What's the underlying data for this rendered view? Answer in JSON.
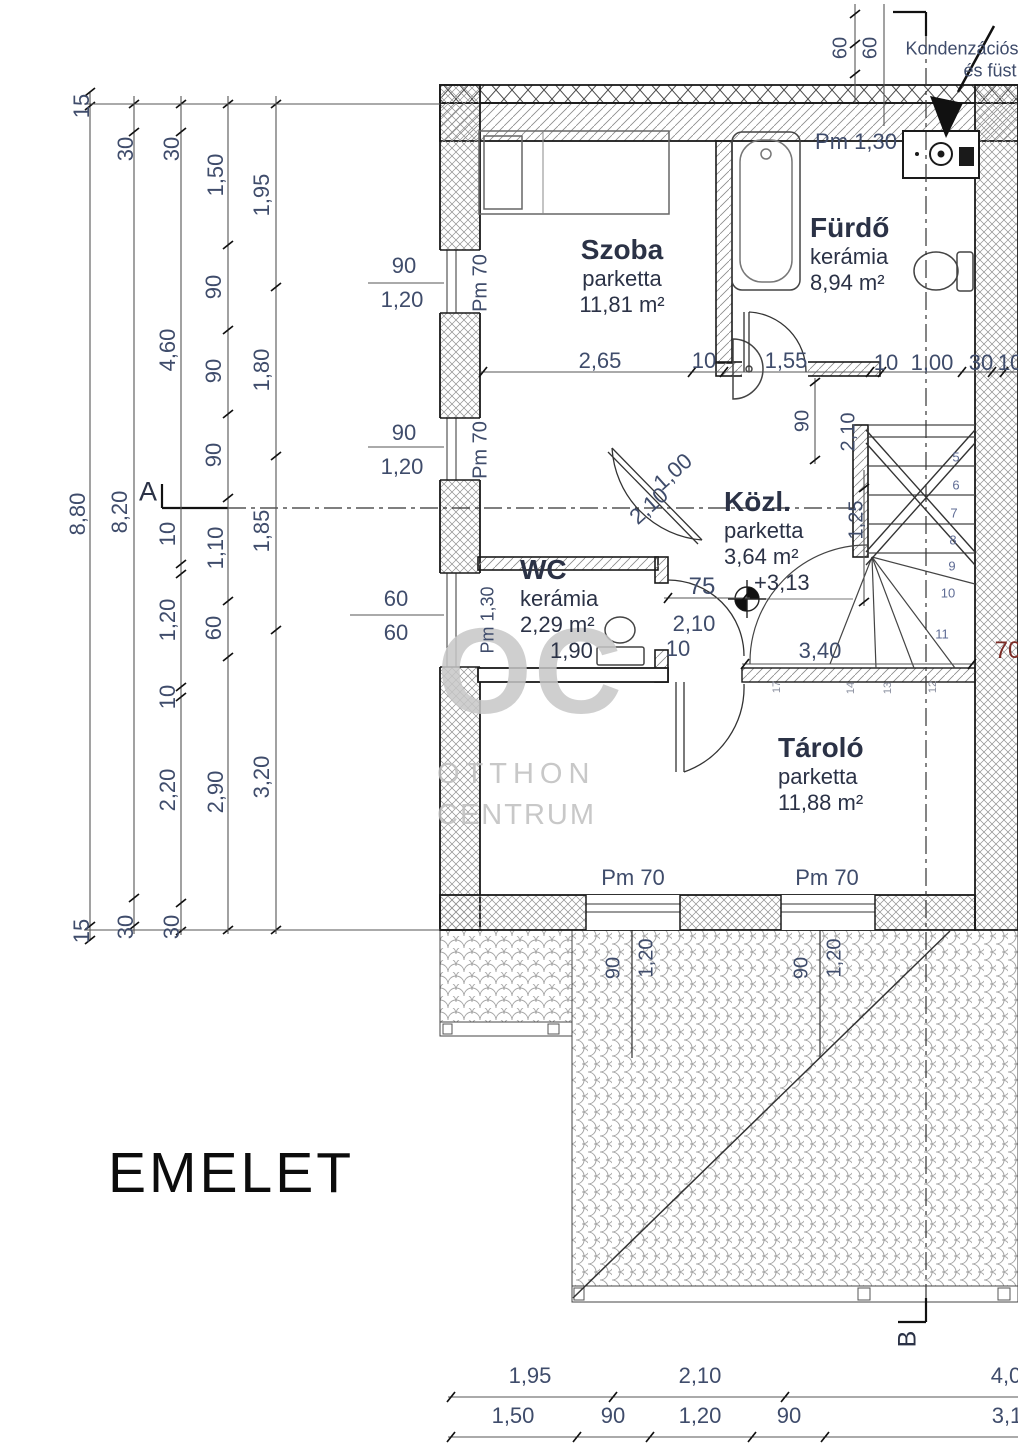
{
  "title": {
    "floor_label": "EMELET"
  },
  "watermark": {
    "line1": "OC",
    "line2": "OTTHON",
    "line3": "CENTRUM"
  },
  "annotation": {
    "line1": "Kondenzációs",
    "line2": "és füst"
  },
  "rooms": [
    {
      "name": "Szoba",
      "floor": "parketta",
      "area": "11,81 m²",
      "x": 622,
      "y": 234,
      "align": "center"
    },
    {
      "name": "Fürdő",
      "floor": "kerámia",
      "area": "8,94 m²",
      "x": 810,
      "y": 212,
      "align": "left"
    },
    {
      "name": "Közl.",
      "floor": "parketta",
      "area": "3,64 m²",
      "x": 724,
      "y": 486,
      "align": "left",
      "extra": "+3,13"
    },
    {
      "name": "WC",
      "floor": "kerámia",
      "area": "2,29 m²",
      "x": 520,
      "y": 554,
      "align": "left",
      "extra": "1,90"
    },
    {
      "name": "Tároló",
      "floor": "parketta",
      "area": "11,88 m²",
      "x": 778,
      "y": 732,
      "align": "left"
    }
  ],
  "labels": [
    {
      "n": "dim-left-a-15-top",
      "t": "15",
      "x": 82,
      "y": 106,
      "r": -90
    },
    {
      "n": "dim-left-a-880",
      "t": "8,80",
      "x": 78,
      "y": 514,
      "r": -90
    },
    {
      "n": "dim-left-a-15-bot",
      "t": "15",
      "x": 82,
      "y": 931,
      "r": -90
    },
    {
      "n": "dim-left-b-30-top",
      "t": "30",
      "x": 126,
      "y": 149,
      "r": -90
    },
    {
      "n": "dim-left-b-820",
      "t": "8,20",
      "x": 120,
      "y": 512,
      "r": -90
    },
    {
      "n": "dim-left-b-30-bot",
      "t": "30",
      "x": 126,
      "y": 927,
      "r": -90
    },
    {
      "n": "dim-left-c-30-top",
      "t": "30",
      "x": 172,
      "y": 149,
      "r": -90
    },
    {
      "n": "dim-left-c-460",
      "t": "4,60",
      "x": 168,
      "y": 350,
      "r": -90
    },
    {
      "n": "dim-left-c-10a",
      "t": "10",
      "x": 168,
      "y": 534,
      "r": -90
    },
    {
      "n": "dim-left-c-120",
      "t": "1,20",
      "x": 168,
      "y": 620,
      "r": -90
    },
    {
      "n": "dim-left-c-10b",
      "t": "10",
      "x": 168,
      "y": 697,
      "r": -90
    },
    {
      "n": "dim-left-c-220",
      "t": "2,20",
      "x": 168,
      "y": 790,
      "r": -90
    },
    {
      "n": "dim-left-c-30-bot",
      "t": "30",
      "x": 172,
      "y": 927,
      "r": -90
    },
    {
      "n": "dim-left-d-150",
      "t": "1,50",
      "x": 216,
      "y": 175,
      "r": -90
    },
    {
      "n": "dim-left-d-90a",
      "t": "90",
      "x": 214,
      "y": 287,
      "r": -90
    },
    {
      "n": "dim-left-d-90b",
      "t": "90",
      "x": 214,
      "y": 371,
      "r": -90
    },
    {
      "n": "dim-left-d-90c",
      "t": "90",
      "x": 214,
      "y": 455,
      "r": -90
    },
    {
      "n": "dim-left-d-110",
      "t": "1,10",
      "x": 216,
      "y": 548,
      "r": -90
    },
    {
      "n": "dim-left-d-60",
      "t": "60",
      "x": 214,
      "y": 628,
      "r": -90
    },
    {
      "n": "dim-left-d-290",
      "t": "2,90",
      "x": 216,
      "y": 792,
      "r": -90
    },
    {
      "n": "dim-left-e-195",
      "t": "1,95",
      "x": 262,
      "y": 195,
      "r": -90
    },
    {
      "n": "dim-left-e-180",
      "t": "1,80",
      "x": 262,
      "y": 370,
      "r": -90
    },
    {
      "n": "dim-left-e-185",
      "t": "1,85",
      "x": 262,
      "y": 531,
      "r": -90
    },
    {
      "n": "dim-left-e-320",
      "t": "3,20",
      "x": 262,
      "y": 777,
      "r": -90
    },
    {
      "n": "section-a-label",
      "t": "A",
      "x": 148,
      "y": 492,
      "s": 27,
      "c": "#2b3246"
    },
    {
      "n": "section-b-label",
      "t": "B",
      "x": 908,
      "y": 1339,
      "r": -90,
      "s": 25,
      "c": "#2b3246"
    },
    {
      "n": "dim-win1-90",
      "t": "90",
      "x": 404,
      "y": 266
    },
    {
      "n": "dim-win1-120",
      "t": "1,20",
      "x": 402,
      "y": 300
    },
    {
      "n": "dim-win2-90",
      "t": "90",
      "x": 404,
      "y": 433
    },
    {
      "n": "dim-win2-120",
      "t": "1,20",
      "x": 402,
      "y": 467
    },
    {
      "n": "dim-wcwin-60a",
      "t": "60",
      "x": 396,
      "y": 599
    },
    {
      "n": "dim-wcwin-60b",
      "t": "60",
      "x": 396,
      "y": 633
    },
    {
      "n": "win1-parapet",
      "t": "Pm 70",
      "x": 481,
      "y": 283,
      "r": -90,
      "s": 20
    },
    {
      "n": "win2-parapet",
      "t": "Pm 70",
      "x": 481,
      "y": 450,
      "r": -90,
      "s": 20
    },
    {
      "n": "wcwin-parapet",
      "t": "Pm 1,30",
      "x": 488,
      "y": 620,
      "r": -90,
      "s": 18
    },
    {
      "n": "dim-top-60a",
      "t": "60",
      "x": 841,
      "y": 48,
      "r": -90,
      "s": 20
    },
    {
      "n": "dim-top-60b",
      "t": "60",
      "x": 871,
      "y": 48,
      "r": -90,
      "s": 20
    },
    {
      "n": "furdo-parapet",
      "t": "Pm 1,30",
      "x": 856,
      "y": 142,
      "s": 22
    },
    {
      "n": "flue-note-line1",
      "t": "Kondenzációs",
      "x": 962,
      "y": 49,
      "s": 18
    },
    {
      "n": "flue-note-line2",
      "t": "és füst",
      "x": 990,
      "y": 71,
      "s": 18
    },
    {
      "n": "dim-mid-265",
      "t": "2,65",
      "x": 600,
      "y": 361
    },
    {
      "n": "dim-mid-10a",
      "t": "10",
      "x": 704,
      "y": 361
    },
    {
      "n": "dim-mid-155",
      "t": "1,55",
      "x": 786,
      "y": 361
    },
    {
      "n": "dim-mid-10b",
      "t": "10",
      "x": 886,
      "y": 363
    },
    {
      "n": "dim-mid-100",
      "t": "1,00",
      "x": 932,
      "y": 363
    },
    {
      "n": "dim-mid-30",
      "t": "30",
      "x": 981,
      "y": 363
    },
    {
      "n": "dim-mid-10c",
      "t": "10",
      "x": 1010,
      "y": 363
    },
    {
      "n": "dim-furdo-door-90",
      "t": "90",
      "x": 803,
      "y": 421,
      "r": -90,
      "s": 20
    },
    {
      "n": "dim-furdo-door-210",
      "t": "2,10",
      "x": 849,
      "y": 432,
      "r": -90,
      "s": 20
    },
    {
      "n": "dim-stair-125",
      "t": "1,25",
      "x": 857,
      "y": 520,
      "r": -90,
      "s": 20
    },
    {
      "n": "dim-szoba-door-100",
      "t": "1,00",
      "x": 673,
      "y": 472,
      "r": -42
    },
    {
      "n": "dim-szoba-door-210",
      "t": "2,10",
      "x": 649,
      "y": 506,
      "r": -42
    },
    {
      "n": "dim-wc-door-75",
      "t": "75",
      "x": 702,
      "y": 587,
      "s": 24
    },
    {
      "n": "dim-wc-door-210",
      "t": "2,10",
      "x": 694,
      "y": 624
    },
    {
      "n": "dim-wc-door-10",
      "t": "10",
      "x": 678,
      "y": 649
    },
    {
      "n": "stair-step-5",
      "t": "5",
      "x": 956,
      "y": 457,
      "s": 13,
      "c": "#5f6c95"
    },
    {
      "n": "stair-step-6",
      "t": "6",
      "x": 956,
      "y": 485,
      "s": 13,
      "c": "#5f6c95"
    },
    {
      "n": "stair-step-7",
      "t": "7",
      "x": 954,
      "y": 513,
      "s": 13,
      "c": "#5f6c95"
    },
    {
      "n": "stair-step-8",
      "t": "8",
      "x": 953,
      "y": 540,
      "s": 13,
      "c": "#5f6c95"
    },
    {
      "n": "stair-step-9",
      "t": "9",
      "x": 952,
      "y": 566,
      "s": 13,
      "c": "#5f6c95"
    },
    {
      "n": "stair-step-10",
      "t": "10",
      "x": 948,
      "y": 593,
      "s": 13,
      "c": "#5f6c95"
    },
    {
      "n": "stair-step-11",
      "t": "11",
      "x": 942,
      "y": 634,
      "s": 13,
      "c": "#5f6c95"
    },
    {
      "n": "stair-step-17",
      "t": "17",
      "x": 777,
      "y": 687,
      "r": -90,
      "s": 11,
      "c": "#8a8f9f"
    },
    {
      "n": "stair-step-14",
      "t": "14",
      "x": 851,
      "y": 688,
      "r": -90,
      "s": 11,
      "c": "#8a8f9f"
    },
    {
      "n": "stair-step-13",
      "t": "13",
      "x": 888,
      "y": 688,
      "r": -90,
      "s": 11,
      "c": "#8a8f9f"
    },
    {
      "n": "stair-step-12",
      "t": "12",
      "x": 933,
      "y": 687,
      "r": -90,
      "s": 11,
      "c": "#8a8f9f"
    },
    {
      "n": "dim-stair-340",
      "t": "3,40",
      "x": 820,
      "y": 651
    },
    {
      "n": "dim-right-70",
      "t": "70",
      "x": 1008,
      "y": 651,
      "s": 24,
      "c": "#7b2b26"
    },
    {
      "n": "botwin1-parapet",
      "t": "Pm 70",
      "x": 633,
      "y": 878,
      "s": 22
    },
    {
      "n": "botwin2-parapet",
      "t": "Pm 70",
      "x": 827,
      "y": 878,
      "s": 22
    },
    {
      "n": "dim-roof1-90",
      "t": "90",
      "x": 614,
      "y": 968,
      "r": -90,
      "s": 20
    },
    {
      "n": "dim-roof1-120",
      "t": "1,20",
      "x": 647,
      "y": 958,
      "r": -90,
      "s": 20
    },
    {
      "n": "dim-roof2-90",
      "t": "90",
      "x": 802,
      "y": 968,
      "r": -90,
      "s": 20
    },
    {
      "n": "dim-roof2-120",
      "t": "1,20",
      "x": 835,
      "y": 958,
      "r": -90,
      "s": 20
    },
    {
      "n": "dim-bot1-195",
      "t": "1,95",
      "x": 530,
      "y": 1376
    },
    {
      "n": "dim-bot1-210",
      "t": "2,10",
      "x": 700,
      "y": 1376
    },
    {
      "n": "dim-bot1-40",
      "t": "4,0",
      "x": 1006,
      "y": 1376
    },
    {
      "n": "dim-bot2-150",
      "t": "1,50",
      "x": 513,
      "y": 1416
    },
    {
      "n": "dim-bot2-90a",
      "t": "90",
      "x": 613,
      "y": 1416
    },
    {
      "n": "dim-bot2-120",
      "t": "1,20",
      "x": 700,
      "y": 1416
    },
    {
      "n": "dim-bot2-90b",
      "t": "90",
      "x": 789,
      "y": 1416
    },
    {
      "n": "dim-bot2-31",
      "t": "3,1",
      "x": 1007,
      "y": 1416
    }
  ],
  "dims": {
    "chains": [
      {
        "o": "v",
        "x": 90,
        "a": 92,
        "b": 941,
        "ticks": [
          92,
          106,
          926,
          940
        ]
      },
      {
        "o": "v",
        "x": 134,
        "a": 96,
        "b": 934,
        "ticks": [
          104,
          132,
          898,
          926
        ]
      },
      {
        "o": "v",
        "x": 181,
        "a": 96,
        "b": 935,
        "ticks": [
          104,
          132,
          564,
          574,
          687,
          697,
          903,
          931
        ]
      },
      {
        "o": "v",
        "x": 228,
        "a": 96,
        "b": 934,
        "ticks": [
          104,
          245,
          330,
          414,
          498,
          601,
          657,
          930
        ]
      },
      {
        "o": "v",
        "x": 276,
        "a": 96,
        "b": 934,
        "ticks": [
          104,
          287,
          456,
          630,
          930
        ]
      },
      {
        "o": "v",
        "x": 855,
        "a": 4,
        "b": 103,
        "ticks": [
          14,
          44,
          74
        ]
      },
      {
        "o": "v",
        "x": 884,
        "a": 4,
        "b": 126,
        "ticks": []
      },
      {
        "o": "v",
        "x": 815,
        "a": 378,
        "b": 464,
        "ticks": [
          382,
          460
        ]
      },
      {
        "o": "v",
        "x": 864,
        "a": 470,
        "b": 606,
        "ticks": [
          488,
          602
        ]
      },
      {
        "o": "h",
        "y": 372,
        "a": 480,
        "b": 1018,
        "ticks": [
          483,
          692,
          724,
          870,
          882,
          962,
          992,
          1004
        ]
      },
      {
        "o": "h",
        "y": 598,
        "a": 664,
        "b": 750,
        "ticks": [
          668,
          744
        ]
      },
      {
        "o": "h",
        "y": 664,
        "a": 742,
        "b": 975,
        "ticks": [
          745,
          972
        ]
      },
      {
        "o": "h",
        "y": 1397,
        "a": 448,
        "b": 1018,
        "ticks": [
          451,
          613,
          785
        ]
      },
      {
        "o": "h",
        "y": 1437,
        "a": 448,
        "b": 1018,
        "ticks": [
          451,
          577,
          650,
          752,
          825
        ]
      },
      {
        "o": "h",
        "y": 104,
        "a": 84,
        "b": 440,
        "ticks": []
      },
      {
        "o": "h",
        "y": 930,
        "a": 84,
        "b": 440,
        "ticks": []
      },
      {
        "o": "h",
        "y": 283,
        "a": 368,
        "b": 444,
        "ticks": []
      },
      {
        "o": "h",
        "y": 447,
        "a": 368,
        "b": 444,
        "ticks": []
      },
      {
        "o": "h",
        "y": 615,
        "a": 350,
        "b": 444,
        "ticks": []
      }
    ]
  }
}
